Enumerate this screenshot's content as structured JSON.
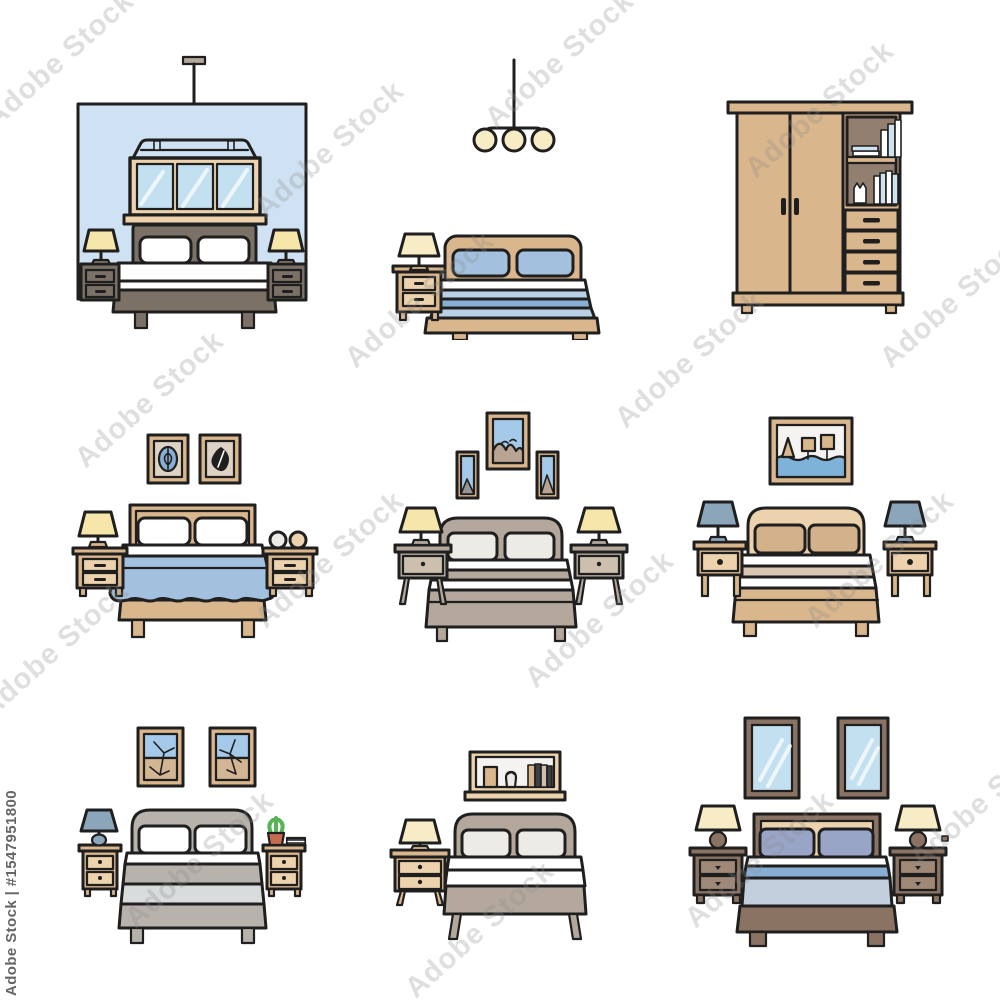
{
  "image": {
    "kind": "stock vector illustration",
    "title": "Bedroom furniture thin line icon set",
    "grid": "3x3",
    "background": "#ffffff"
  },
  "watermark": {
    "tile_text": "Adobe Stock",
    "credit_text": "Adobe Stock | #1547951800",
    "tile_color": "#8c8c8c",
    "credit_color": "#4b4b4b"
  },
  "palette": {
    "ink": "#1f1f1f",
    "white": "#ffffff",
    "offWhite": "#edebe6",
    "paper": "#f4f3f1",
    "wallBlue": "#cfe2f3",
    "glass": "#c3e0f0",
    "sky": "#a5c9e8",
    "water": "#7fb2d8",
    "tan": "#d9b68c",
    "tanLight": "#ecd3ae",
    "beigeMat": "#ddd2c3",
    "land": "#d2b694",
    "taupeDark": "#7b7166",
    "taupeMid": "#b4a89c",
    "taupeInterior": "#937f70",
    "taupePale": "#cdbfae",
    "mountain": "#b9a493",
    "grayBed": "#b7b3ac",
    "grayPale": "#d8dcdc",
    "blue": "#a3c1de",
    "blueMed": "#88afd3",
    "blueLight": "#b9d0e7",
    "steel": "#c3cedd",
    "periwinkle": "#99a5c7",
    "brown": "#8a7362",
    "brownLight": "#a08876",
    "cream": "#f7ecc6",
    "yellow": "#f7e6a9",
    "blueGray": "#8ba6bb",
    "bookBlue": "#cfe2ee",
    "green": "#56b456",
    "terracotta": "#c66a50",
    "darkBook": "#3f3f3f",
    "wm": "#8c8c8c",
    "wmDark": "#4b4b4b"
  },
  "icons": [
    {
      "id": "bedroom-blue-wall-window",
      "row": 1,
      "col": 1,
      "desc": "Double bed with dark headboard and two nightstands with lamps, three-pane window and hanging rod on a blue wall"
    },
    {
      "id": "bed-with-pendant-lights",
      "row": 1,
      "col": 2,
      "desc": "Double bed with blue striped bedding, left nightstand with lamp, three-bulb pendant light"
    },
    {
      "id": "wardrobe",
      "row": 1,
      "col": 3,
      "desc": "Two-door wardrobe with open book shelves and four drawers"
    },
    {
      "id": "bed-blue-blanket-two-pictures",
      "row": 2,
      "col": 1,
      "desc": "Double bed with draped blue blanket, two framed pictures, nightstands with lamp and decor balls"
    },
    {
      "id": "bed-three-pictures",
      "row": 2,
      "col": 2,
      "desc": "Double bed with striped taupe cover, two single-drawer nightstands with lamps, three mountain pictures"
    },
    {
      "id": "bed-seascape-picture",
      "row": 2,
      "col": 3,
      "desc": "Double bed with tan bedding, two nightstands with gray lamps, framed seascape with boats"
    },
    {
      "id": "bed-two-landscape-pictures",
      "row": 3,
      "col": 1,
      "desc": "Gray double bed, nightstands with lamp, plant and book, two framed landscapes"
    },
    {
      "id": "bed-wall-shelf",
      "row": 3,
      "col": 2,
      "desc": "Double bed with left nightstand and lamp, wall shelf holding a box, candle and books"
    },
    {
      "id": "bed-two-mirrors",
      "row": 3,
      "col": 3,
      "desc": "Double bed with blue bedding, two nightstands with lamps, two wall mirrors"
    }
  ]
}
